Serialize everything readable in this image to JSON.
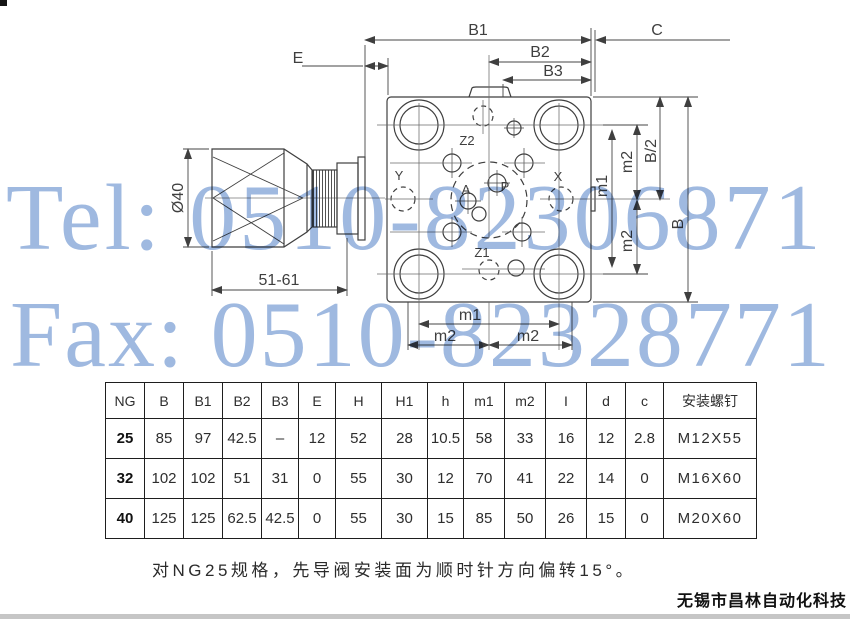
{
  "watermark": {
    "tel": "Tel: 0510-82306871",
    "fax": "Fax: 0510-82328771",
    "color": "#9fb9e0"
  },
  "note": "对NG25规格，先导阀安装面为顺时针方向偏转15°。",
  "footer": {
    "company": "无锡市昌林自动化科技"
  },
  "drawing": {
    "labels": {
      "b1": "B1",
      "b2": "B2",
      "b3": "B3",
      "c": "C",
      "e": "E",
      "dia40": "Ø40",
      "len": "51-61",
      "z2": "Z2",
      "z1": "Z1",
      "x": "X",
      "y": "Y",
      "a": "A",
      "p": "P",
      "m1_right": "m1",
      "m2_right_top": "m2",
      "b_half": "B/2",
      "m2_right_bottom": "m2",
      "b": "B",
      "m1_bottom": "m1",
      "m2_bottom_left": "m2",
      "m2_bottom_right": "m2"
    }
  },
  "table": {
    "headers": [
      "NG",
      "B",
      "B1",
      "B2",
      "B3",
      "E",
      "H",
      "H1",
      "h",
      "m1",
      "m2",
      "I",
      "d",
      "c",
      "安装螺钉"
    ],
    "rows": [
      [
        "25",
        "85",
        "97",
        "42.5",
        "–",
        "12",
        "52",
        "28",
        "10.5",
        "58",
        "33",
        "16",
        "12",
        "2.8",
        "M12X55"
      ],
      [
        "32",
        "102",
        "102",
        "51",
        "31",
        "0",
        "55",
        "30",
        "12",
        "70",
        "41",
        "22",
        "14",
        "0",
        "M16X60"
      ],
      [
        "40",
        "125",
        "125",
        "62.5",
        "42.5",
        "0",
        "55",
        "30",
        "15",
        "85",
        "50",
        "26",
        "15",
        "0",
        "M20X60"
      ]
    ]
  }
}
